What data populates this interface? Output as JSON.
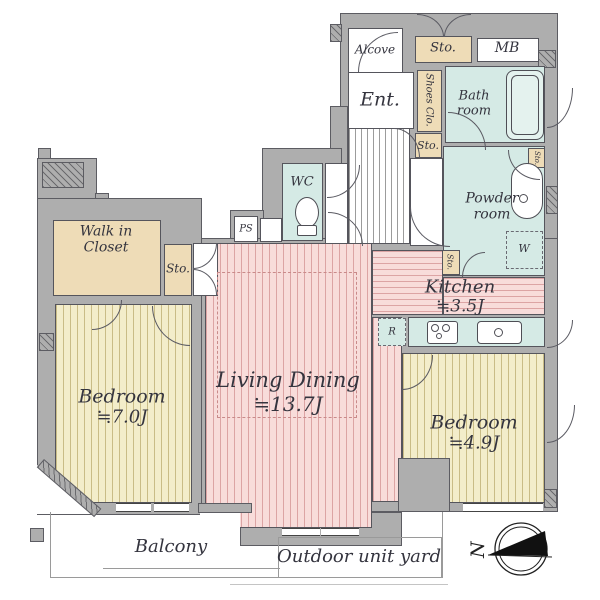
{
  "colors": {
    "wall": "#aeaeae",
    "wall_edge": "#5c5c62",
    "pink": "#f8dcda",
    "pink_stripe": "#dca4a4",
    "yellow": "#f3edca",
    "yellow_stripe": "#c9bc86",
    "teal": "#d5eae5",
    "beige": "#eedcb7",
    "hall_stripe": "#9c9c9c",
    "text": "#34343e"
  },
  "rooms": {
    "alcove": "Alcove",
    "sto_top": "Sto.",
    "mb": "MB",
    "ent": "Ent.",
    "shoes_clo": "Shoes Clo.",
    "bath": "Bath room",
    "sto_hall": "Sto.",
    "wc": "WC",
    "ps": "PS",
    "powder": "Powder room",
    "sto_powder": "Sto.",
    "washer": "W",
    "sto_kitchen": "Sto.",
    "fridge": "R",
    "kitchen": {
      "name": "Kitchen",
      "size": "≒3.5J"
    },
    "wic": "Walk in Closet",
    "sto_wic": "Sto.",
    "bedroom_left": {
      "name": "Bedroom",
      "size": "≒7.0J"
    },
    "living": {
      "name": "Living Dining",
      "size": "≒13.7J"
    },
    "bedroom_right": {
      "name": "Bedroom",
      "size": "≒4.9J"
    }
  },
  "outside": {
    "balcony": "Balcony",
    "yard": "Outdoor unit yard",
    "compass_north": "N"
  }
}
